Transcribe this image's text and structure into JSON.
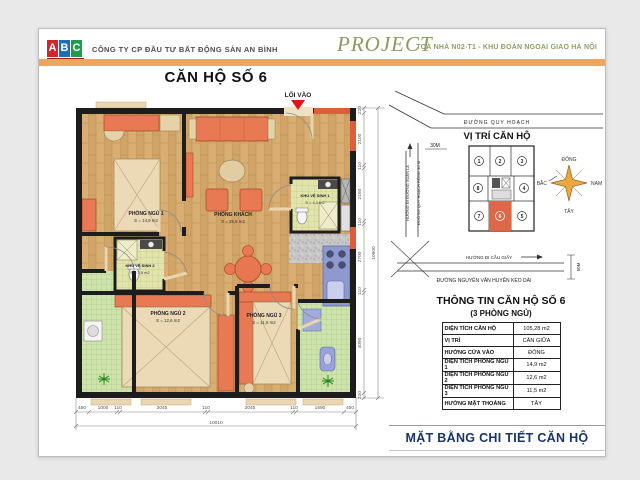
{
  "colors": {
    "accent_bar": "#efa55c",
    "olive_text": "#8a9a62",
    "logo_red": "#d0262c",
    "logo_blue": "#1a6fb8",
    "logo_green": "#1e9e4a",
    "highlight_unit": "#dd6747",
    "entry_arrow": "#e01616",
    "footer_text": "#17356b"
  },
  "header": {
    "logo": {
      "letters": [
        "A",
        "B",
        "C"
      ],
      "land": "LAND"
    },
    "company": "CÔNG TY CP ĐẦU TƯ BẤT ĐỘNG SẢN AN BÌNH",
    "project_label": "PROJECT",
    "project_subtitle": "TOÀ NHÀ N02-T1 - KHU ĐOÀN NGOẠI GIAO HÀ NỘI"
  },
  "plan": {
    "title": "CĂN HỘ SỐ 6",
    "entry_label": "LỐI VÀO",
    "rooms": [
      {
        "name": "PHÒNG NGỦ 1",
        "area": "S = 14,9 m2"
      },
      {
        "name": "PHÒNG KHÁCH",
        "area": "S = 25,5 m2"
      },
      {
        "name": "KHU VỆ SINH 1",
        "area": "S = 4,1 m2"
      },
      {
        "name": "KHU VỆ SINH 2",
        "area": "S = 3,5 m2"
      },
      {
        "name": "PHÒNG NGỦ 2",
        "area": "S = 12,6 m2"
      },
      {
        "name": "PHÒNG NGỦ 3",
        "area": "S = 11,5 m2"
      }
    ],
    "dims_bottom": [
      "450",
      "1000",
      "110",
      "3045",
      "110",
      "3045",
      "110",
      "1690",
      "450"
    ],
    "dims_bottom_total": "10010",
    "dims_right": [
      "220",
      "2100",
      "110",
      "2160",
      "110",
      "2700",
      "110",
      "4090",
      "220"
    ],
    "dims_right_total": "10900"
  },
  "location": {
    "title": "VỊ TRÍ CĂN HỘ",
    "road_top": "ĐƯỜNG QUY HOẠCH",
    "road_left_1": "HƯỚNG ĐI ĐƯỜNG XUÂN LA",
    "road_left_2": "ĐƯỜNG QUY HOẠCH RỘNG 30 M",
    "road_left_width": "30M",
    "road_bottom_direction": "HƯỚNG ĐI CẦU GIẤY",
    "road_bottom_name": "ĐƯỜNG NGUYỄN VĂN HUYÊN KÉO DÀI",
    "road_bottom_width": "50M",
    "units": [
      "1",
      "2",
      "3",
      "8",
      "4",
      "7",
      "6",
      "5"
    ],
    "highlighted_unit": "6",
    "compass": {
      "east": "ĐÔNG",
      "north": "BẮC",
      "south": "NAM",
      "west": "TÂY"
    }
  },
  "info": {
    "title": "THÔNG TIN CĂN HỘ SỐ 6",
    "subtitle": "(3 PHÒNG NGỦ)",
    "rows": [
      {
        "label": "DIỆN TÍCH CĂN HỘ",
        "value": "105,28 m2"
      },
      {
        "label": "VỊ TRÍ",
        "value": "CĂN GIỮA"
      },
      {
        "label": "HƯỚNG CỬA VÀO",
        "value": "ĐÔNG"
      },
      {
        "label": "DIỆN TÍCH PHÒNG NGỦ 1",
        "value": "14,9 m2"
      },
      {
        "label": "DIỆN TÍCH PHÒNG NGỦ 2",
        "value": "12,6 m2"
      },
      {
        "label": "DIỆN TÍCH PHÒNG NGỦ 3",
        "value": "11,5 m2"
      },
      {
        "label": "HƯỚNG MẶT THOÁNG",
        "value": "TÂY"
      }
    ]
  },
  "footer": {
    "title": "MẶT BẰNG CHI TIẾT CĂN HỘ"
  }
}
